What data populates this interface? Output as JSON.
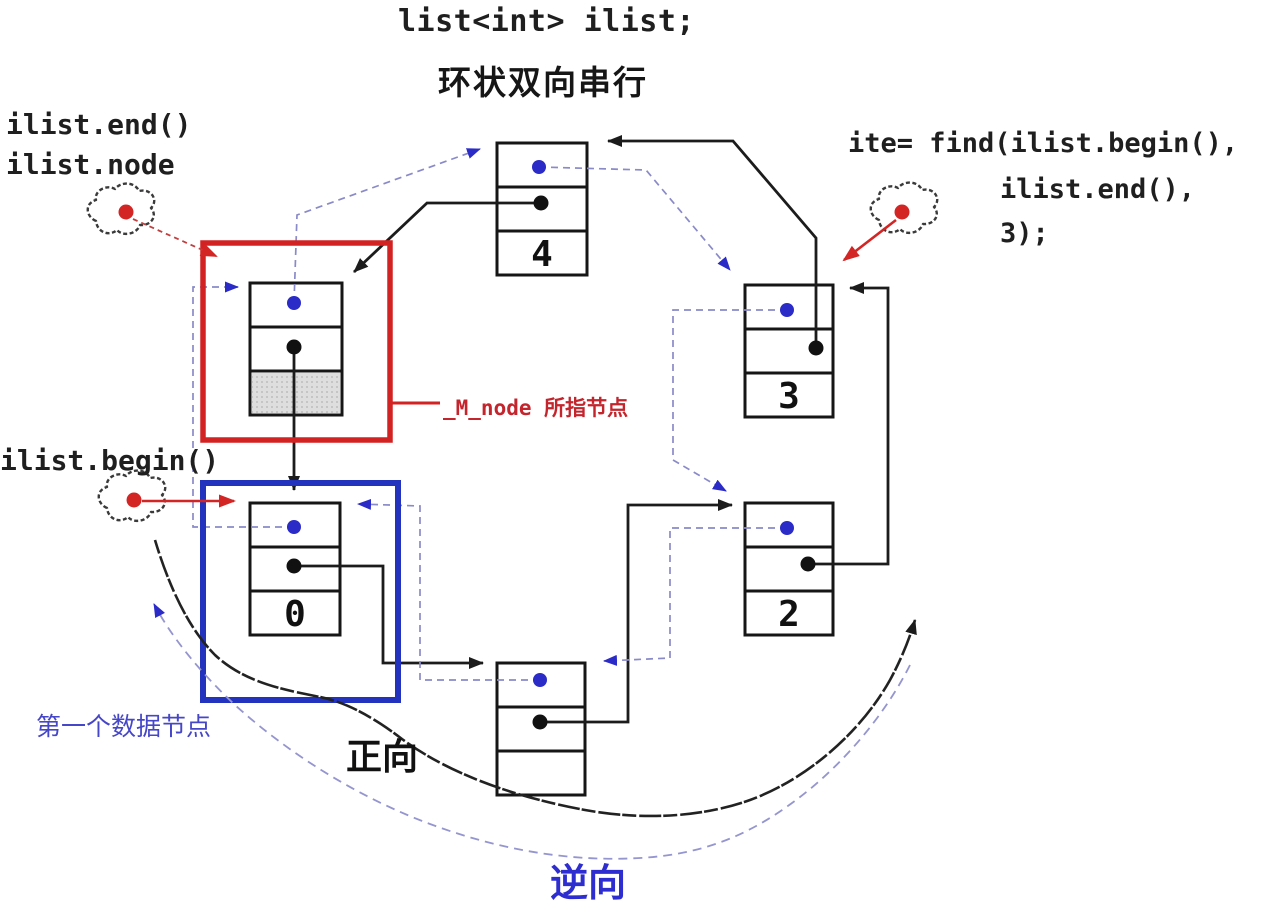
{
  "header": {
    "code_title": "list<int> ilist;",
    "subtitle": "环状双向串行"
  },
  "annotations": {
    "end_label": "ilist.end()",
    "node_label": "ilist.node",
    "begin_label": "ilist.begin()",
    "find_line1": "ite= find(ilist.begin(),",
    "find_line2": "ilist.end(),",
    "find_line3": "3);",
    "m_node_note": "_M_node 所指节点",
    "first_data_node_note": "第一个数据节点",
    "forward_label": "正向",
    "backward_label": "逆向"
  },
  "nodes": [
    {
      "id": "sentinel-end-node",
      "value": "",
      "highlight": "red-box"
    },
    {
      "id": "node-4",
      "value": "4",
      "highlight": ""
    },
    {
      "id": "node-3",
      "value": "3",
      "highlight": ""
    },
    {
      "id": "node-2",
      "value": "2",
      "highlight": ""
    },
    {
      "id": "node-1",
      "value": "",
      "highlight": ""
    },
    {
      "id": "node-0",
      "value": "0",
      "highlight": "blue-box"
    }
  ],
  "colors": {
    "next_pointer_black": "#1c1c1c",
    "prev_pointer_blue": "#2b2bc8",
    "prev_dash_line": "#8a8ac9",
    "highlight_red_box": "#d32222",
    "highlight_blue_box": "#2433bd",
    "annotation_red": "#c4242c",
    "note_blue": "#4646c8",
    "cloud_dot_red": "#d42525",
    "shaded_cell_gray": "#dedede"
  }
}
